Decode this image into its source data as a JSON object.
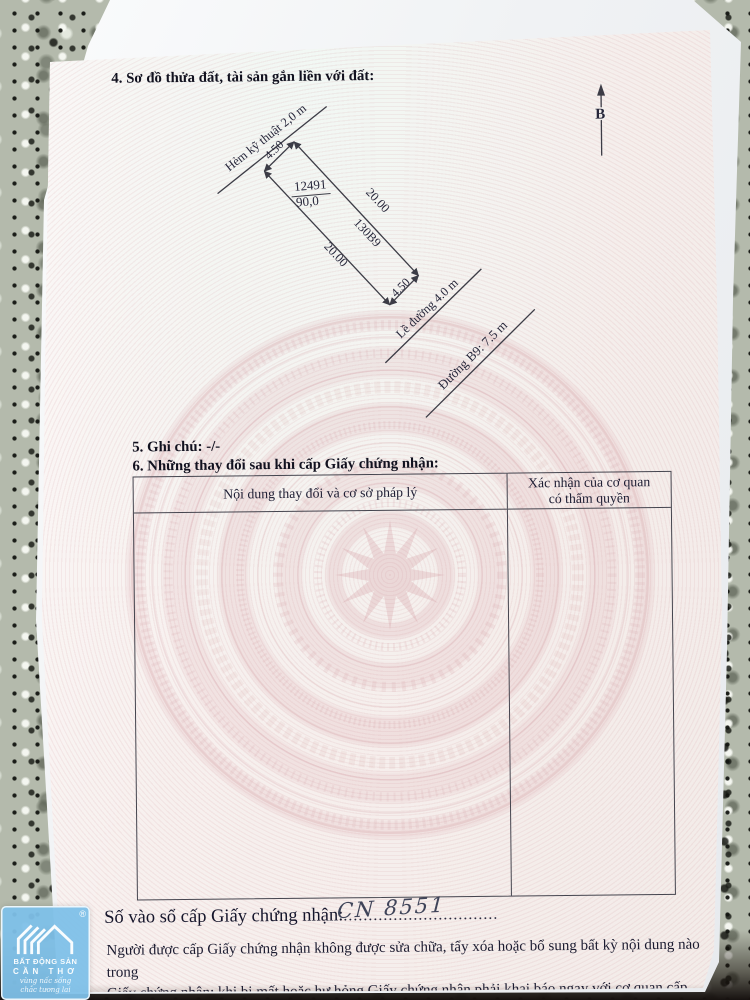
{
  "document": {
    "section4_title": "4. Sơ đồ thửa đất, tài sản gắn liền với đất:",
    "section5_title": "5. Ghi chú: -/-",
    "section6_title": "6. Những thay đổi sau khi cấp Giấy chứng nhận:",
    "registry_label": "Số vào sổ cấp Giấy chứng nhận:",
    "registry_number_handwritten": "CN 8551",
    "registry_dotted_line": "...............................",
    "footer_line1": "Người được cấp Giấy chứng nhận không được sửa chữa, tẩy xóa hoặc bổ sung bất kỳ nội dung nào trong",
    "footer_line2": "Giấy chứng nhận; khi bị mất hoặc hư hỏng Giấy chứng nhận phải khai báo ngay với cơ quan cấp Giấy."
  },
  "table": {
    "col1_header": "Nội dung thay đổi và cơ sở pháp lý",
    "col2_header_line1": "Xác nhận của cơ quan",
    "col2_header_line2": "có thẩm quyền"
  },
  "diagram": {
    "north_label": "B",
    "alley_label": "Hẻm kỹ thuật 2,0 m",
    "parcel_number": "12491",
    "parcel_area": "90,0",
    "block_code": "130B9",
    "width_front": "4.50",
    "width_back": "4.50",
    "length_left": "20.00",
    "length_right": "20.00",
    "curb_label": "Lề đường 4.0 m",
    "road_label": "Đường B9: 7.5 m"
  },
  "watermark": {
    "brand_line1": "BẤT ĐỘNG SẢN",
    "brand_line2": "CẦN THƠ",
    "slogan_line1": "vùng nấc sống",
    "slogan_line2": "chắc tương lai",
    "registered": "®"
  },
  "colors": {
    "paper_tint": "#f7f0ee",
    "guilloche_pink": "#c98089",
    "ink": "#1d1d33",
    "logo_blue": "#7ec0e8"
  }
}
